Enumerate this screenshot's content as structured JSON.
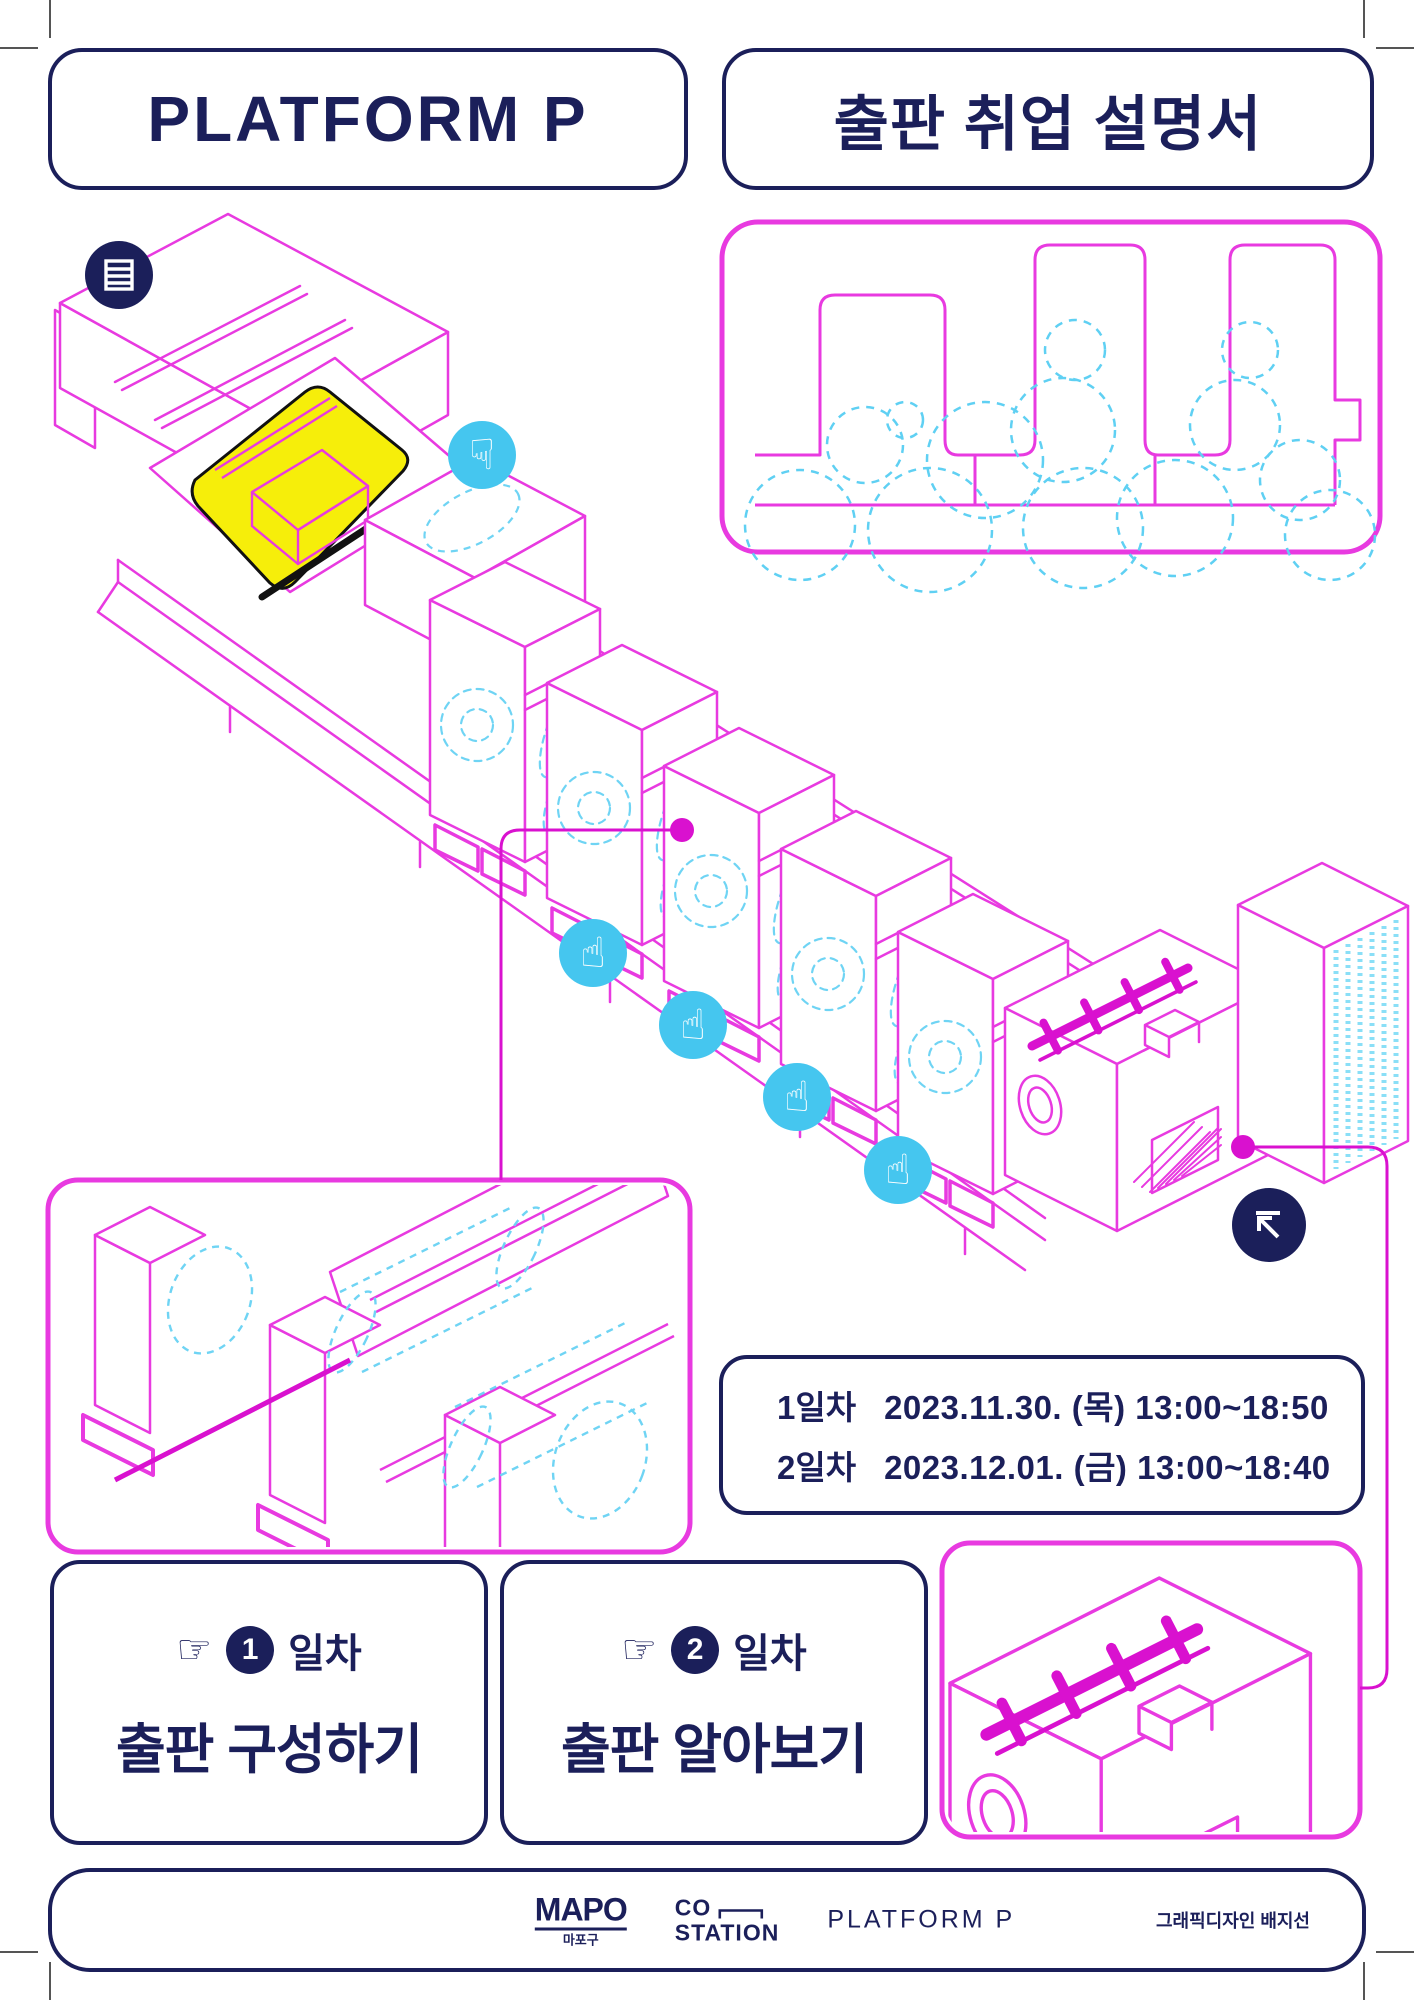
{
  "colors": {
    "navy": "#1b1f5a",
    "magenta": "#e83ae0",
    "magenta_bold": "#d911cf",
    "cyan_circle": "#45c6ef",
    "cyan_dashed": "#6fd4f4",
    "yellow": "#f6ee0a",
    "sheet_outline": "#111111"
  },
  "header": {
    "left_title": "PLATFORM P",
    "right_title": "출판 취업 설명서"
  },
  "schedule": {
    "rows": [
      {
        "day": "1일차",
        "datetime": "2023.11.30. (목) 13:00~18:50"
      },
      {
        "day": "2일차",
        "datetime": "2023.12.01. (금) 13:00~18:40"
      }
    ]
  },
  "day_cards": [
    {
      "pointer": "☞",
      "number": "1",
      "suffix": "일차",
      "title": "출판 구성하기"
    },
    {
      "pointer": "☞",
      "number": "2",
      "suffix": "일차",
      "title": "출판 알아보기"
    }
  ],
  "icons": {
    "hand_down": "☟",
    "hand_up": "☝",
    "document_icon": "document-lines",
    "arrow_icon": "arrow-up-left-corner"
  },
  "footer": {
    "mapo_name": "MAPO",
    "mapo_caption": "마포구",
    "costation_line1": "CO",
    "costation_line2": "STATION",
    "platform_wordmark": "PLATFORM P",
    "credit": "그래픽디자인 배지선"
  }
}
